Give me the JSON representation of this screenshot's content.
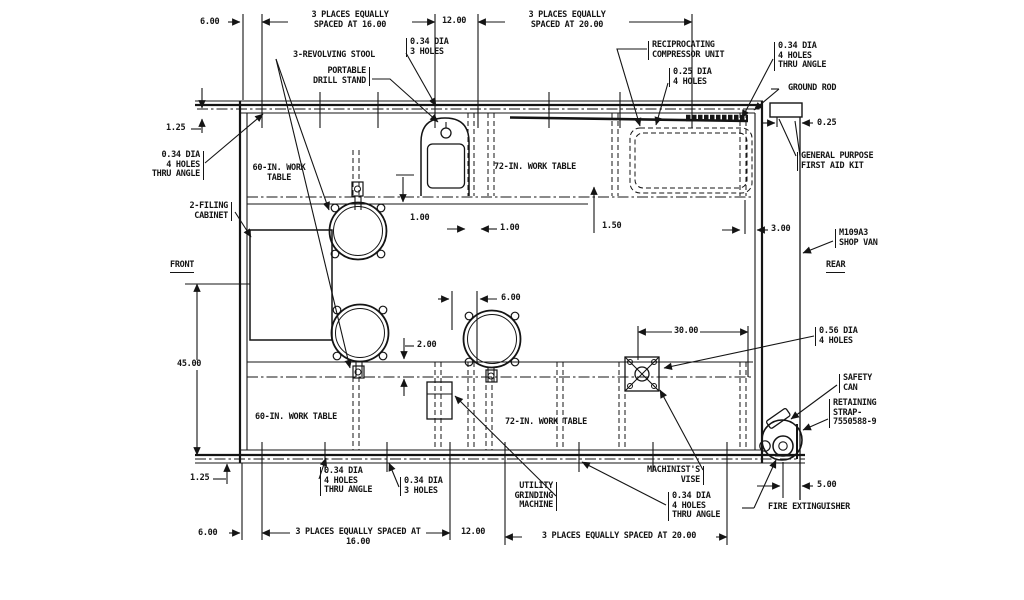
{
  "drawing": {
    "type": "floor-plan engineering drawing",
    "subject": "M109A3 SHOP VAN equipment layout"
  },
  "labels": {
    "d6_top": "6.00",
    "d16_top": "3 PLACES EQUALLY\nSPACED AT 16.00",
    "d12_top": "12.00",
    "d20_top": "3 PLACES EQUALLY\nSPACED AT 20.00",
    "hole34_3_top": "0.34 DIA\n3 HOLES",
    "stool": "3-REVOLVING STOOL",
    "drill": "PORTABLE\nDRILL STAND",
    "recip": "RECIPROCATING\nCOMPRESSOR UNIT",
    "hole25_4": "0.25 DIA\n4 HOLES",
    "hole34_4_tr": "0.34 DIA\n4 HOLES\nTHRU ANGLE",
    "ground_rod": "GROUND ROD",
    "d025": "0.25",
    "first_aid": "GENERAL PURPOSE\nFIRST AID KIT",
    "d125_tl": "1.25",
    "hole34_4_tl": "0.34 DIA\n4 HOLES\nTHRU ANGLE",
    "t60_top": "60-IN. WORK\nTABLE",
    "t72_top": "72-IN. WORK TABLE",
    "filing": "2-FILING\nCABINET",
    "front": "FRONT",
    "d100_a": "1.00",
    "d100_b": "1.00",
    "d150": "1.50",
    "d300": "3.00",
    "m109a3": "M109A3\nSHOP VAN",
    "rear": "REAR",
    "d45": "45.00",
    "d6_mid": "6.00",
    "d200": "2.00",
    "d3000": "30.00",
    "hole56": "0.56 DIA\n4 HOLES",
    "safety_can": "SAFETY\nCAN",
    "retaining": "RETAINING\nSTRAP-\n7550588-9",
    "t60_bot": "60-IN. WORK TABLE",
    "t72_bot": "72-IN. WORK TABLE",
    "d125_bl": "1.25",
    "hole34_4_bl": "0.34 DIA\n4 HOLES\nTHRU ANGLE",
    "hole34_3_bot": "0.34 DIA\n3 HOLES",
    "utility": "UTILITY\nGRINDING\nMACHINE",
    "vise": "MACHINIST'S\nVISE",
    "hole34_4_br": "0.34 DIA\n4 HOLES\nTHRU ANGLE",
    "fire_ext": "FIRE EXTINGUISHER",
    "d500": "5.00",
    "d6_bot": "6.00",
    "d16_bot": "3 PLACES EQUALLY SPACED AT\n16.00",
    "d12_bot": "12.00",
    "d20_bot": "3 PLACES EQUALLY SPACED AT 20.00"
  }
}
